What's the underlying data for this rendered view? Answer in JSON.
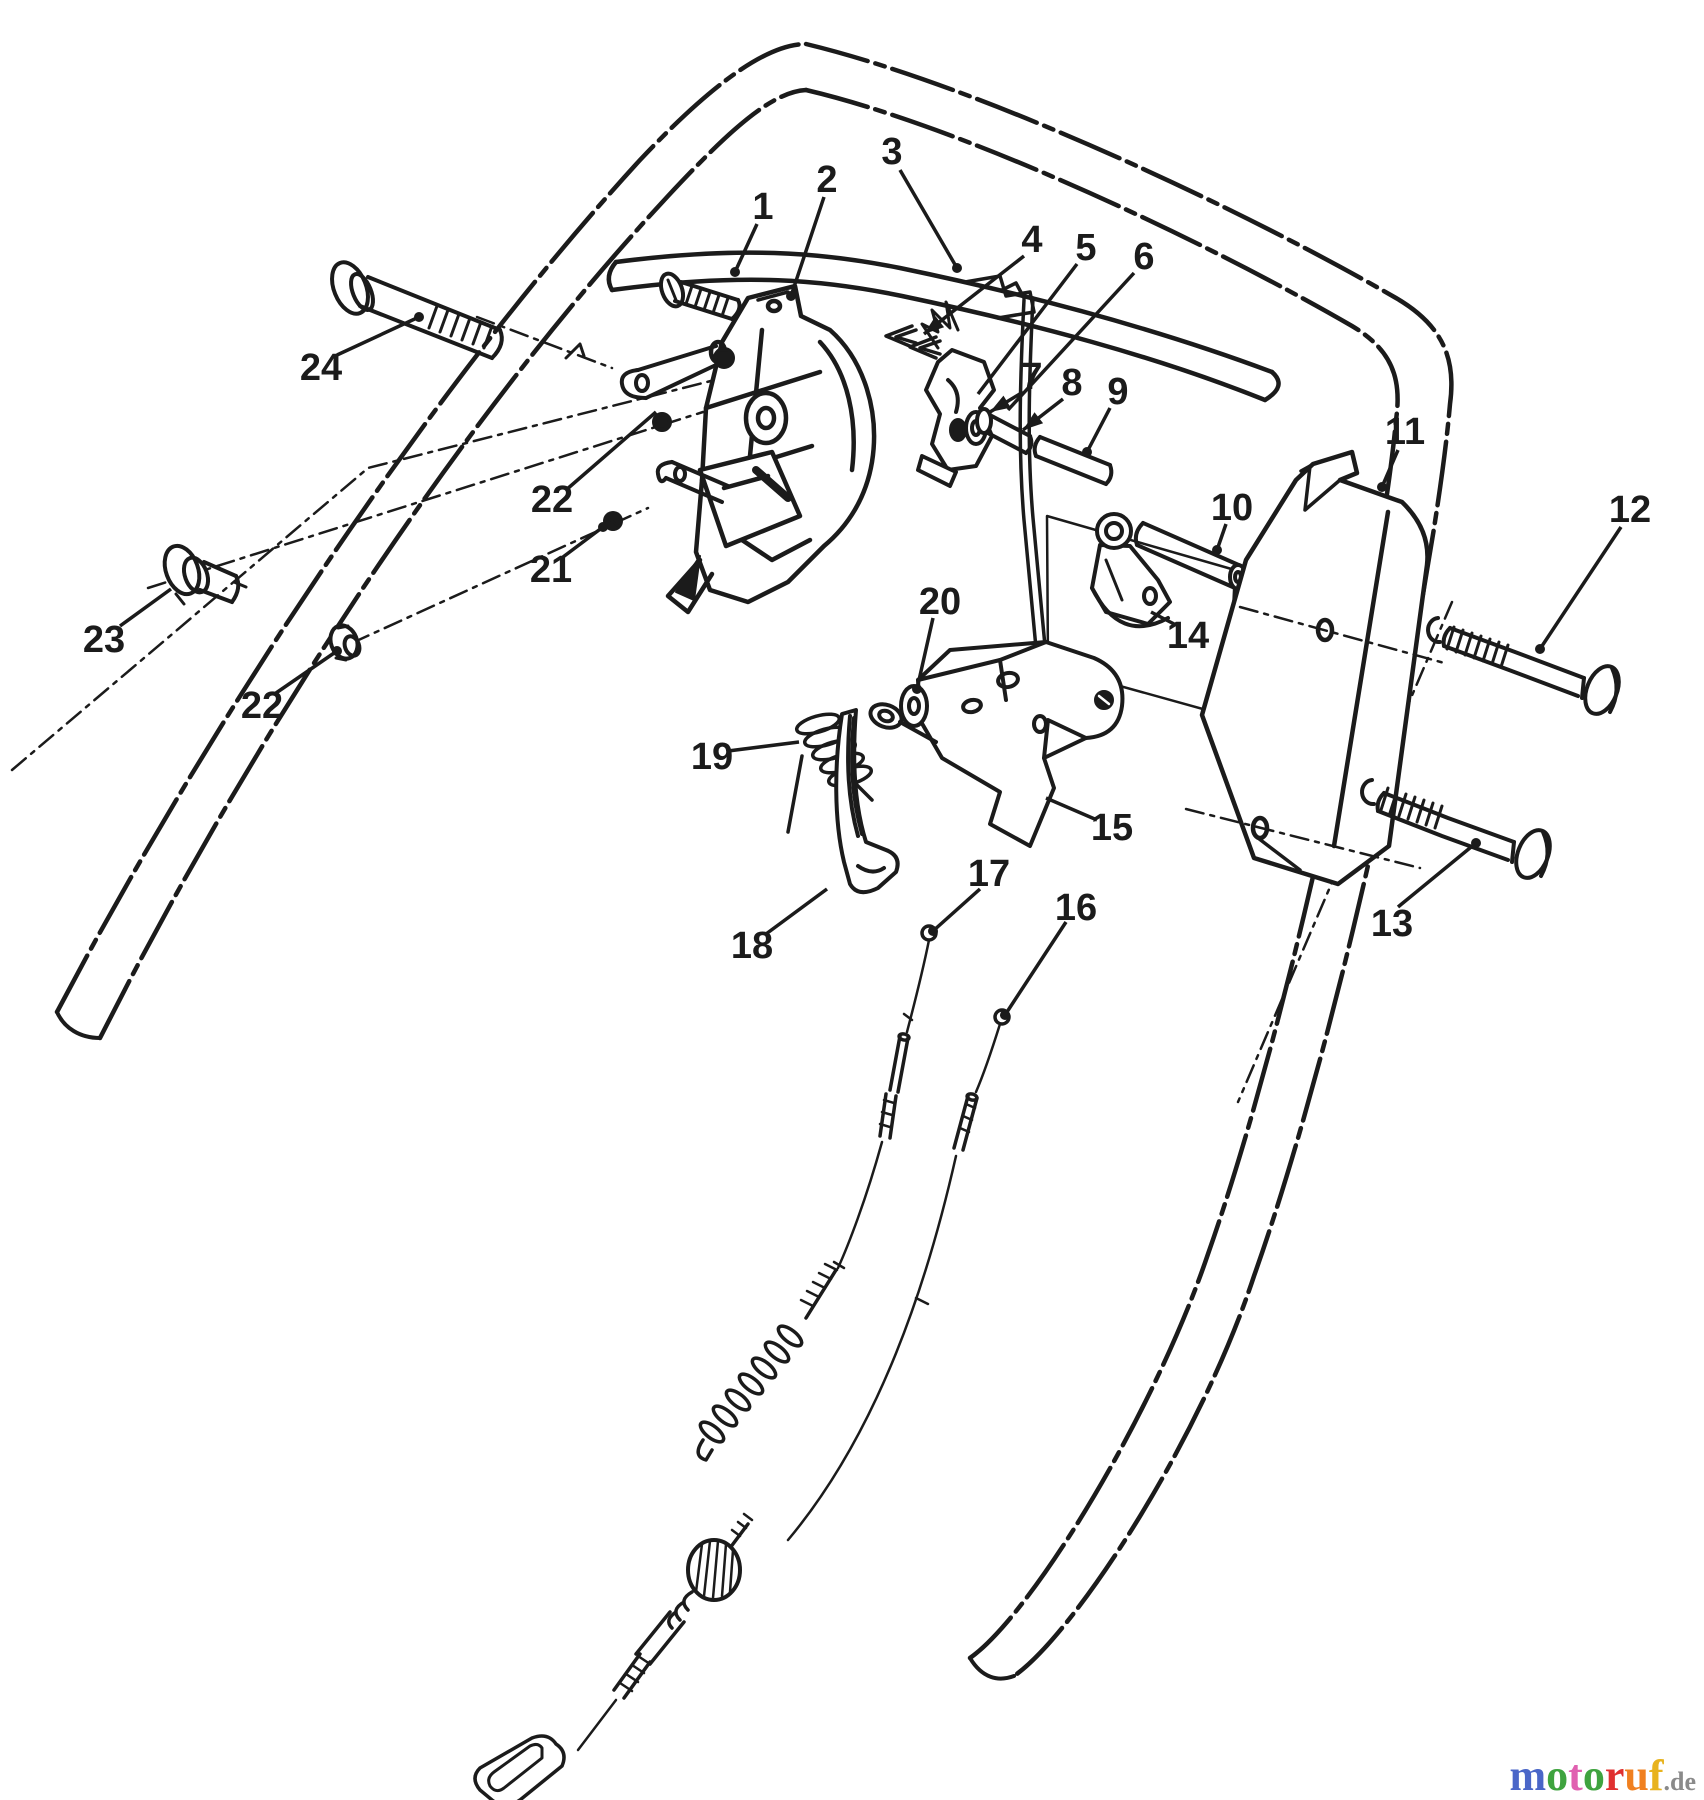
{
  "diagram": {
    "ink": "#1b1b1b",
    "background": "#ffffff",
    "part_labels": [
      {
        "id": "1",
        "text": "1",
        "x": 763,
        "y": 207,
        "leader": [
          757,
          224,
          735,
          272
        ],
        "tip": "dot"
      },
      {
        "id": "2",
        "text": "2",
        "x": 827,
        "y": 180,
        "leader": [
          824,
          197,
          791,
          296
        ],
        "tip": "dot"
      },
      {
        "id": "3",
        "text": "3",
        "x": 892,
        "y": 152,
        "leader": [
          900,
          170,
          957,
          268
        ],
        "tip": "dot"
      },
      {
        "id": "4",
        "text": "4",
        "x": 1032,
        "y": 240,
        "leader": [
          1024,
          256,
          924,
          334
        ],
        "tip": "arrow"
      },
      {
        "id": "5",
        "text": "5",
        "x": 1086,
        "y": 248,
        "leader": [
          1077,
          264,
          978,
          394
        ],
        "tip": "none"
      },
      {
        "id": "6",
        "text": "6",
        "x": 1144,
        "y": 257,
        "leader": [
          1134,
          273,
          1008,
          410
        ],
        "tip": "none"
      },
      {
        "id": "7",
        "text": "7",
        "x": 1032,
        "y": 377,
        "leader": [
          1023,
          392,
          990,
          412
        ],
        "tip": "arrow"
      },
      {
        "id": "8",
        "text": "8",
        "x": 1072,
        "y": 383,
        "leader": [
          1063,
          399,
          1023,
          430
        ],
        "tip": "arrow"
      },
      {
        "id": "9",
        "text": "9",
        "x": 1118,
        "y": 392,
        "leader": [
          1110,
          408,
          1087,
          452
        ],
        "tip": "dot"
      },
      {
        "id": "10",
        "text": "10",
        "x": 1232,
        "y": 508,
        "leader": [
          1226,
          524,
          1217,
          550
        ],
        "tip": "dot"
      },
      {
        "id": "11",
        "text": "11",
        "x": 1405,
        "y": 432,
        "leader": [
          1398,
          450,
          1382,
          487
        ],
        "tip": "dot"
      },
      {
        "id": "12",
        "text": "12",
        "x": 1630,
        "y": 510,
        "leader": [
          1621,
          527,
          1540,
          649
        ],
        "tip": "dot"
      },
      {
        "id": "13",
        "text": "13",
        "x": 1392,
        "y": 924,
        "leader": [
          1398,
          907,
          1476,
          843
        ],
        "tip": "dot"
      },
      {
        "id": "14",
        "text": "14",
        "x": 1188,
        "y": 636,
        "leader": [
          1176,
          625,
          1151,
          612
        ],
        "tip": "none"
      },
      {
        "id": "15",
        "text": "15",
        "x": 1112,
        "y": 828,
        "leader": [
          1097,
          820,
          1046,
          798
        ],
        "tip": "none"
      },
      {
        "id": "16",
        "text": "16",
        "x": 1076,
        "y": 908,
        "leader": [
          1066,
          922,
          1005,
          1015
        ],
        "tip": "dot"
      },
      {
        "id": "17",
        "text": "17",
        "x": 989,
        "y": 874,
        "leader": [
          980,
          889,
          933,
          931
        ],
        "tip": "dot"
      },
      {
        "id": "18",
        "text": "18",
        "x": 752,
        "y": 946,
        "leader": [
          766,
          934,
          827,
          889
        ],
        "tip": "none"
      },
      {
        "id": "19",
        "text": "19",
        "x": 712,
        "y": 757,
        "leader": [
          728,
          751,
          799,
          742
        ],
        "tip": "none"
      },
      {
        "id": "20",
        "text": "20",
        "x": 940,
        "y": 602,
        "leader": [
          933,
          618,
          917,
          689
        ],
        "tip": "dot"
      },
      {
        "id": "21",
        "text": "21",
        "x": 551,
        "y": 570,
        "leader": [
          563,
          557,
          603,
          527
        ],
        "tip": "dot"
      },
      {
        "id": "22a",
        "text": "22",
        "x": 552,
        "y": 500,
        "leader": [
          566,
          490,
          656,
          412
        ],
        "tip": "none"
      },
      {
        "id": "22b",
        "text": "22",
        "x": 262,
        "y": 706,
        "leader": [
          276,
          693,
          337,
          651
        ],
        "tip": "dot"
      },
      {
        "id": "23",
        "text": "23",
        "x": 104,
        "y": 640,
        "leader": [
          120,
          626,
          171,
          589
        ],
        "tip": "none"
      },
      {
        "id": "24",
        "text": "24",
        "x": 321,
        "y": 368,
        "leader": [
          337,
          355,
          419,
          317
        ],
        "tip": "dot"
      }
    ]
  },
  "watermark": {
    "text": "motoruf.de",
    "letters": [
      {
        "ch": "m",
        "color": "#4a66c8"
      },
      {
        "ch": "o",
        "color": "#3fa33f"
      },
      {
        "ch": "t",
        "color": "#e060b0"
      },
      {
        "ch": "o",
        "color": "#3fa33f"
      },
      {
        "ch": "r",
        "color": "#e03030"
      },
      {
        "ch": "u",
        "color": "#f08020"
      },
      {
        "ch": "f",
        "color": "#e8b31e"
      }
    ],
    "suffix": {
      "text": ".de",
      "color": "#8a8a8a"
    }
  }
}
